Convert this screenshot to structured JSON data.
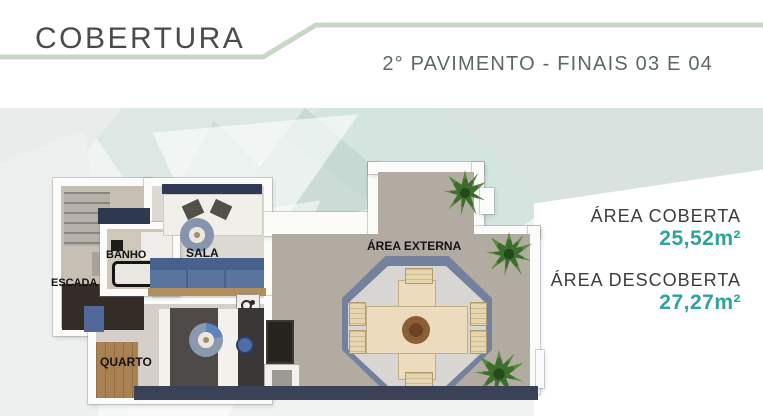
{
  "header": {
    "title": "COBERTURA",
    "subtitle": "2° PAVIMENTO - FINAIS 03 E 04"
  },
  "floorplan": {
    "rooms": [
      {
        "label": "ESCADA"
      },
      {
        "label": "BANHO"
      },
      {
        "label": "SALA"
      },
      {
        "label": "QUARTO"
      },
      {
        "label": "ÁREA EXTERNA"
      }
    ]
  },
  "areas": [
    {
      "label": "ÁREA COBERTA",
      "value": "25,52m²"
    },
    {
      "label": "ÁREA DESCOBERTA",
      "value": "27,27m²"
    }
  ],
  "colors": {
    "accent_teal": "#2ba59b",
    "header_line_green": "#c9d8c6",
    "subtitle_green": "#5a6a5e"
  }
}
